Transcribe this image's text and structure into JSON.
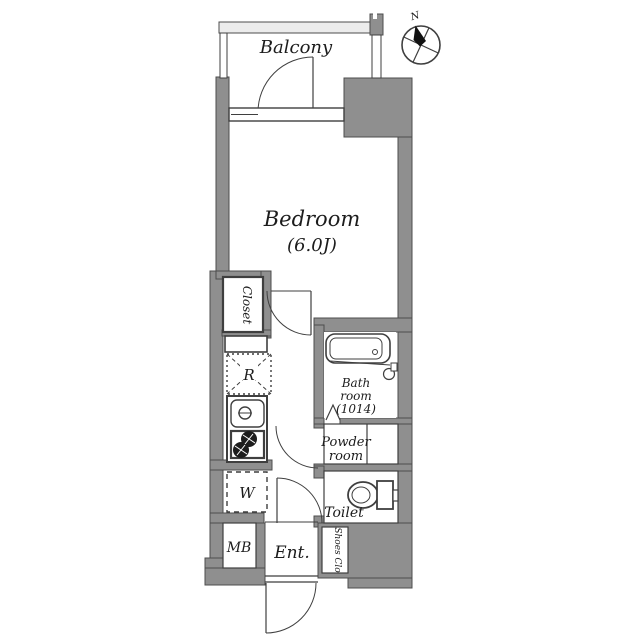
{
  "plan": {
    "type": "apartment-floor-plan",
    "colors": {
      "wall": "#8f8f8f",
      "line": "#3f3f3f",
      "railing": "#ececec",
      "floor": "#ffffff"
    },
    "compass": {
      "north_label": "N"
    },
    "rooms": {
      "balcony": {
        "label": "Balcony"
      },
      "bedroom": {
        "label": "Bedroom",
        "size": "(6.0J)"
      },
      "closet": {
        "label": "Closet"
      },
      "refrigerator": {
        "label": "R"
      },
      "bathroom": {
        "line1": "Bath",
        "line2": "room",
        "line3": "(1014)"
      },
      "powder_room": {
        "line1": "Powder",
        "line2": "room"
      },
      "washer": {
        "label": "W"
      },
      "toilet": {
        "label": "Toilet"
      },
      "meter_box": {
        "label": "MB"
      },
      "entrance": {
        "label": "Ent."
      },
      "shoes_closet": {
        "label": "Shoes Clo"
      }
    }
  }
}
